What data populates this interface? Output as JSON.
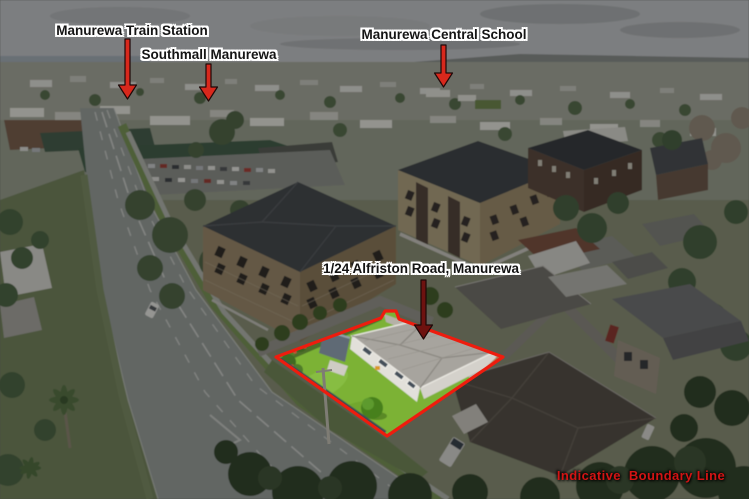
{
  "annotations": {
    "train_station_label": "Manurewa Train Station",
    "southmall_label": "Southmall Manurewa",
    "central_school_label": "Manurewa Central School",
    "property_label": "1/24 Alfriston Road, Manurewa",
    "disclaimer_label": "Indicative  Boundary Line"
  },
  "icons": {
    "train_station_arrow": "arrow-down",
    "southmall_arrow": "arrow-down",
    "central_school_arrow": "arrow-down",
    "property_arrow": "arrow-down"
  },
  "colors": {
    "label_text": "#141414",
    "label_halo": "#ffffff",
    "pointer_arrow_red": "#d8281c",
    "property_arrow_dark_red": "#6e1210",
    "boundary_line_red": "#ee1c0e",
    "disclaimer_red": "#d31414",
    "highlight_lawn_green": "#7cb235",
    "dim_overlay": "rgba(0,0,0,0.36)"
  }
}
